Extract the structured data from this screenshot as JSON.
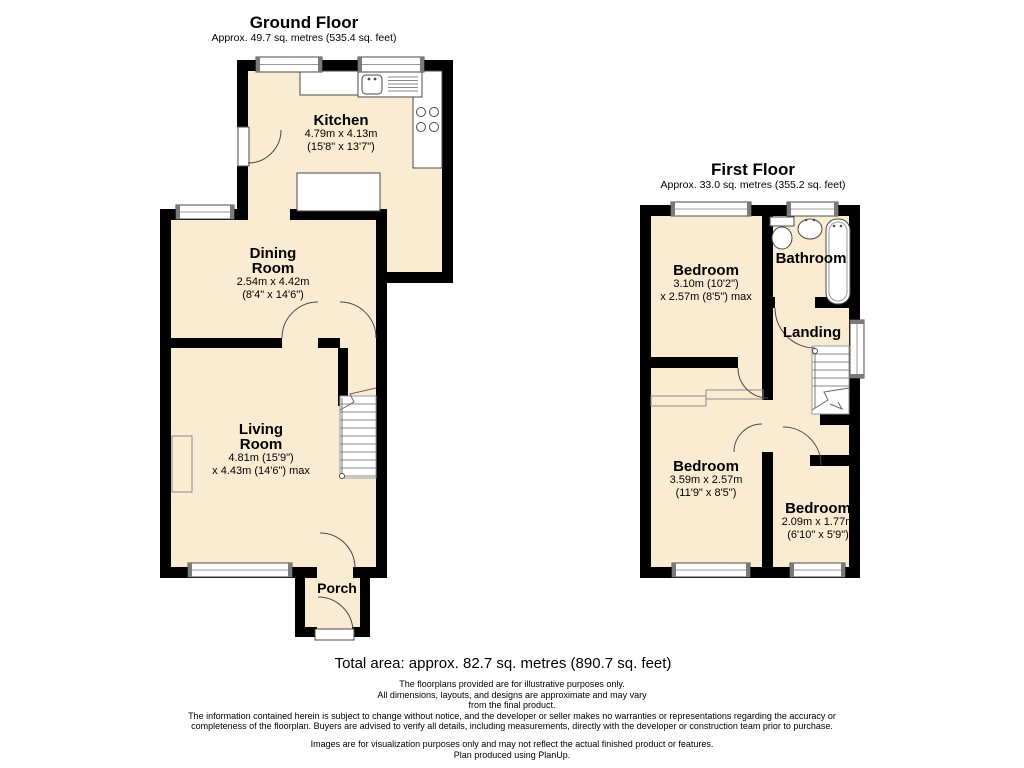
{
  "colors": {
    "floor_fill": "#FAECD2",
    "wall": "#000000",
    "background": "#FFFFFF"
  },
  "ground_floor": {
    "title": "Ground Floor",
    "subtitle": "Approx. 49.7 sq. metres (535.4 sq. feet)",
    "rooms": {
      "kitchen": {
        "name": "Kitchen",
        "dim_metric": "4.79m x 4.13m",
        "dim_imperial": "(15'8\" x 13'7\")"
      },
      "dining": {
        "name_line1": "Dining",
        "name_line2": "Room",
        "dim_metric": "2.54m x 4.42m",
        "dim_imperial": "(8'4\" x 14'6\")"
      },
      "living": {
        "name_line1": "Living",
        "name_line2": "Room",
        "dim_metric": "4.81m (15'9\")",
        "dim_imperial": "x 4.43m (14'6\") max"
      },
      "porch": {
        "name": "Porch"
      }
    }
  },
  "first_floor": {
    "title": "First Floor",
    "subtitle": "Approx. 33.0 sq. metres (355.2 sq. feet)",
    "rooms": {
      "bedroom1": {
        "name": "Bedroom",
        "dim_metric": "3.10m (10'2\")",
        "dim_imperial": "x 2.57m (8'5\") max"
      },
      "bathroom": {
        "name": "Bathroom"
      },
      "landing": {
        "name": "Landing"
      },
      "bedroom2": {
        "name": "Bedroom",
        "dim_metric": "3.59m x 2.57m",
        "dim_imperial": "(11'9\" x 8'5\")"
      },
      "bedroom3": {
        "name": "Bedroom",
        "dim_metric": "2.09m x 1.77m",
        "dim_imperial": "(6'10\" x 5'9\")"
      }
    }
  },
  "footer": {
    "total_area": "Total area: approx. 82.7 sq. metres (890.7 sq. feet)",
    "disclaimer_lines": [
      "The floorplans provided are for illustrative purposes only.",
      "All dimensions, layouts, and designs are approximate and may vary",
      "from the final product.",
      "The information contained herein is subject to change without notice, and the developer or seller makes no warranties or representations regarding the accuracy or",
      "completeness of the floorplan. Buyers are advised to verify all details, including measurements, directly with the developer or construction team prior to purchase."
    ],
    "visualization_note": "Images are for visualization purposes only and may not reflect the actual finished product or features.",
    "produced_by": "Plan produced using PlanUp."
  }
}
